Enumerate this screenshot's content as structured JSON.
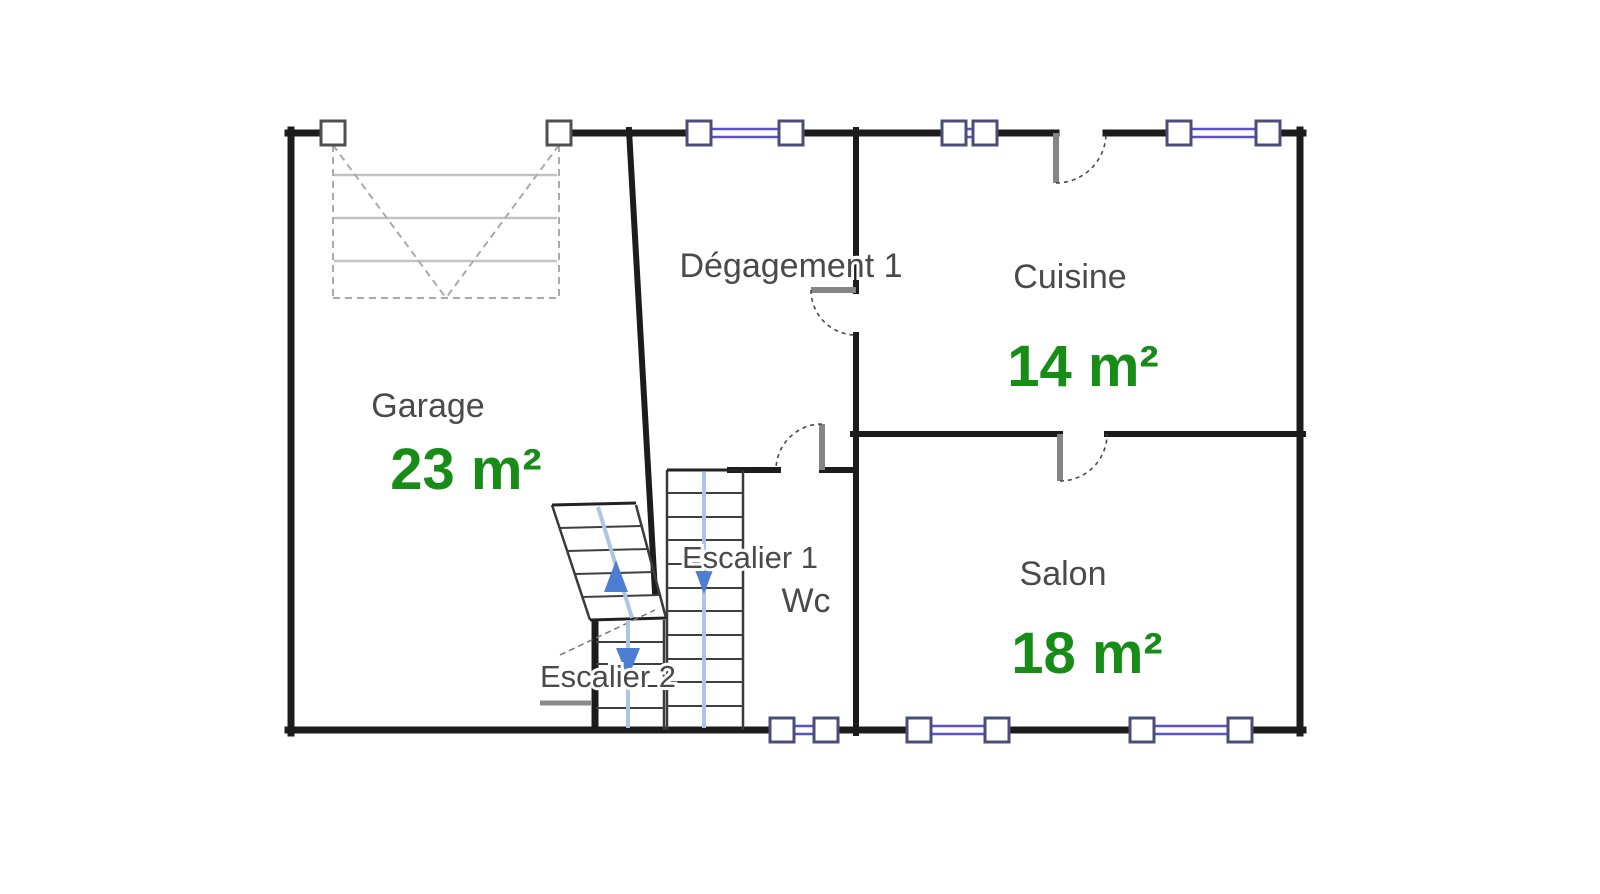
{
  "rooms": {
    "garage": {
      "name": "Garage",
      "area": "23 m²"
    },
    "degagement1": {
      "name": "Dégagement 1"
    },
    "cuisine": {
      "name": "Cuisine",
      "area": "14 m²"
    },
    "salon": {
      "name": "Salon",
      "area": "18 m²"
    },
    "wc": {
      "name": "Wc"
    }
  },
  "stairs": {
    "escalier1": {
      "name": "Escalier 1"
    },
    "escalier2": {
      "name": "Escalier 2"
    }
  },
  "colors": {
    "wall": "#1c1c1c",
    "room_label": "#4a4a4a",
    "area_label": "#178c17",
    "window": "#5a52c6",
    "stair_arrow": "#4d7ed2",
    "stair_guide": "#adc6e6"
  }
}
